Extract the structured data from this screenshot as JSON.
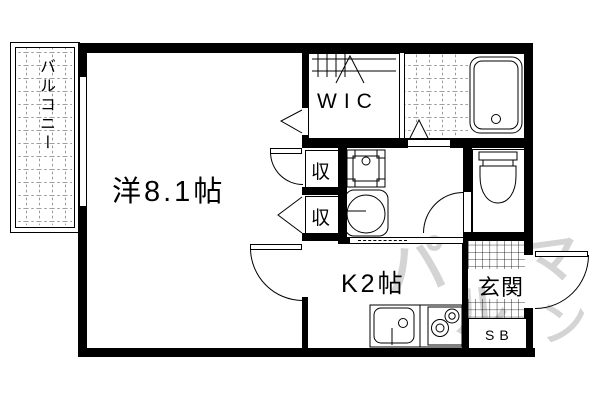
{
  "floorplan": {
    "type": "japanese-apartment-floorplan-1K",
    "colors": {
      "line": "#000000",
      "background": "#ffffff",
      "watermark": "#d4d4d4"
    },
    "rooms": {
      "balcony": {
        "label": "バルコニー"
      },
      "main_room": {
        "label": "洋8.1帖"
      },
      "wic": {
        "label": "WIC"
      },
      "closet_upper": {
        "label": "収"
      },
      "closet_lower": {
        "label": "収"
      },
      "kitchen": {
        "label": "K2帖"
      },
      "entrance": {
        "label": "玄関"
      },
      "shoe_box": {
        "label": "SB"
      }
    },
    "fixtures": [
      "bathtub-icon",
      "toilet-icon",
      "washbasin-icon",
      "washing-machine-pan-icon",
      "kitchen-sink-icon",
      "gas-stove-icon",
      "hanger-pipe-icon"
    ],
    "watermark": {
      "glyphs": [
        "パ",
        "ル",
        "マ",
        "ン"
      ]
    }
  }
}
